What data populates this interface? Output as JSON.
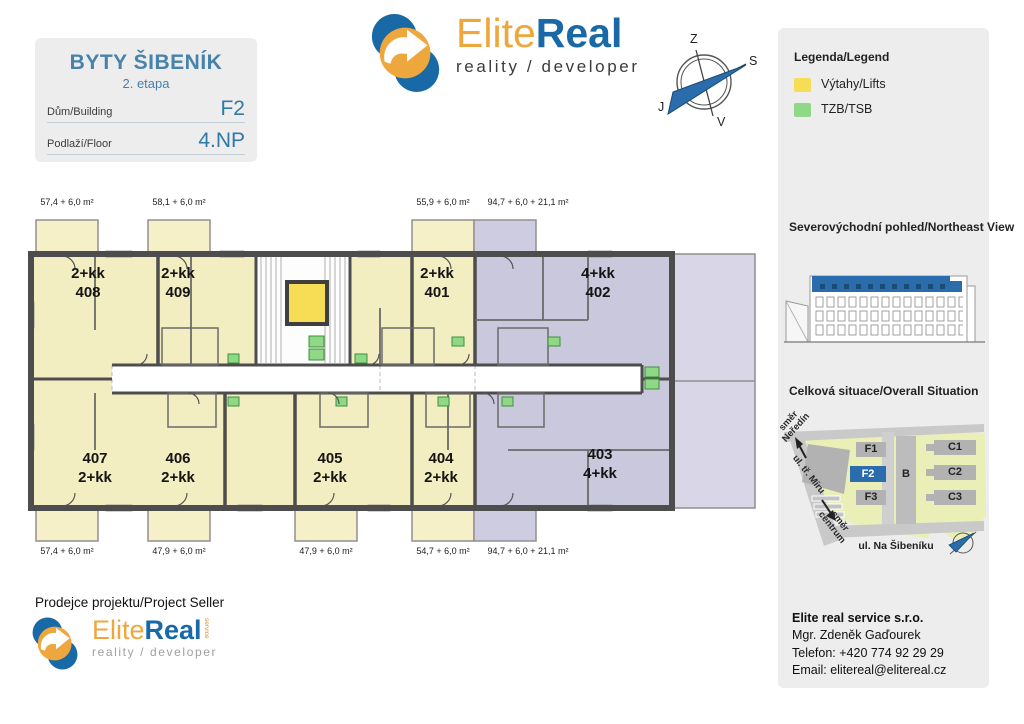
{
  "project": {
    "title": "BYTY ŠIBENÍK",
    "stage": "2. etapa",
    "building_label": "Dům/Building",
    "building_value": "F2",
    "floor_label": "Podlaží/Floor",
    "floor_value": "4.NP"
  },
  "logo": {
    "elite": "Elite",
    "real": "Real",
    "tagline": "reality / developer",
    "service": "service"
  },
  "compass": {
    "west": "Z",
    "north": "S",
    "south": "J",
    "east": "V"
  },
  "legend": {
    "title": "Legenda/Legend",
    "items": [
      {
        "label": "Výtahy/Lifts",
        "color": "#f7dc55"
      },
      {
        "label": "TZB/TSB",
        "color": "#8fd885"
      }
    ]
  },
  "northeast_view": {
    "title": "Severovýchodní pohled/Northeast View"
  },
  "situation": {
    "title": "Celková situace/Overall Situation",
    "buildings": [
      "F1",
      "F2",
      "F3",
      "B",
      "C1",
      "C2",
      "C3"
    ],
    "highlighted": "F2",
    "highlight_color": "#2b6cad",
    "street": "ul. Na Šibeníku",
    "dir_neredin_1": "směr",
    "dir_neredin_2": "Neředín",
    "dir_miru": "ul. tř. Míru",
    "dir_centrum_1": "směr",
    "dir_centrum_2": "centrum"
  },
  "floorplan": {
    "colors": {
      "apartment": "#f3eec2",
      "large_unit": "#cac8dc",
      "lift": "#f7dc55",
      "tzb": "#8fd885"
    },
    "apartments": [
      {
        "line1": "2+kk",
        "line2": "408",
        "area": "57,4 + 6,0 m²"
      },
      {
        "line1": "2+kk",
        "line2": "409",
        "area": "58,1 + 6,0 m²"
      },
      {
        "line1": "2+kk",
        "line2": "401",
        "area": "55,9 + 6,0 m²"
      },
      {
        "line1": "4+kk",
        "line2": "402",
        "area": "94,7 + 6,0 + 21,1 m²"
      },
      {
        "line1": "407",
        "line2": "2+kk",
        "area": "57,4 + 6,0 m²"
      },
      {
        "line1": "406",
        "line2": "2+kk",
        "area": "47,9 + 6,0 m²"
      },
      {
        "line1": "405",
        "line2": "2+kk",
        "area": "47,9 + 6,0 m²"
      },
      {
        "line1": "404",
        "line2": "2+kk",
        "area": "54,7 + 6,0 m²"
      },
      {
        "line1": "403",
        "line2": "4+kk",
        "area": "94,7 + 6,0 + 21,1 m²"
      }
    ]
  },
  "seller": {
    "label": "Prodejce projektu/Project Seller"
  },
  "contact": {
    "company": "Elite real service s.r.o.",
    "person": "Mgr. Zdeněk Gaďourek",
    "phone": "Telefon: +420 774 92 29 29",
    "email": "Email: elitereal@elitereal.cz"
  }
}
